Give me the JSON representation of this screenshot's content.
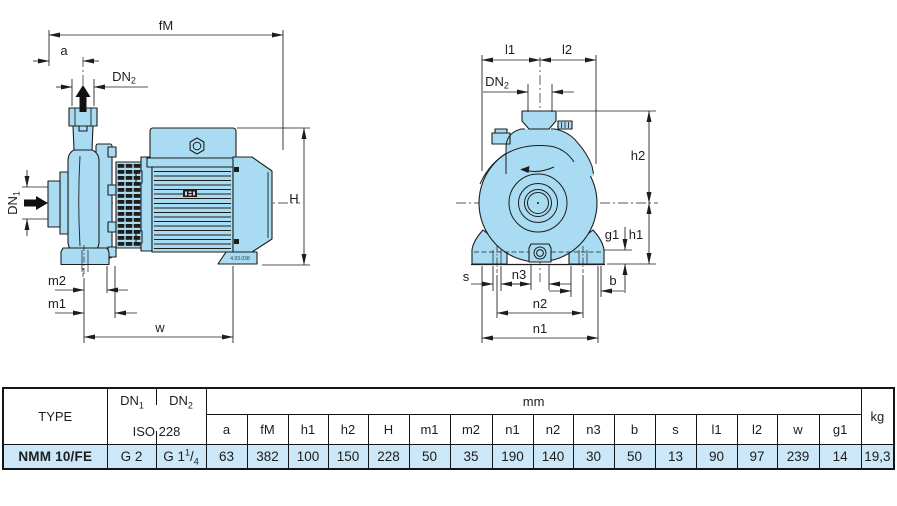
{
  "colors": {
    "pump_fill": "#a9dcf3",
    "line": "#1d1d1b",
    "highlight_row": "#cbe7f8"
  },
  "side_view": {
    "dim_fm": "fM",
    "dim_a": "a",
    "dn2": {
      "base": "DN",
      "sub": "2"
    },
    "dn1": {
      "base": "DN",
      "sub": "1"
    },
    "dim_h": "H",
    "dim_m2": "m2",
    "dim_m1": "m1",
    "dim_w": "w",
    "drawing_no": "4.93.038"
  },
  "front_view": {
    "dim_l1": "l1",
    "dim_l2": "l2",
    "dn2": {
      "base": "DN",
      "sub": "2"
    },
    "dim_h2": "h2",
    "dim_h1": "h1",
    "dim_g1": "g1",
    "dim_s": "s",
    "dim_n3": "n3",
    "dim_b": "b",
    "dim_n2": "n2",
    "dim_n1": "n1"
  },
  "table": {
    "type_header": "TYPE",
    "dn1": {
      "base": "DN",
      "sub": "1"
    },
    "dn2": {
      "base": "DN",
      "sub": "2"
    },
    "iso": "ISO 228",
    "mm": "mm",
    "kg": "kg",
    "dims": [
      "a",
      "fM",
      "h1",
      "h2",
      "H",
      "m1",
      "m2",
      "n1",
      "n2",
      "n3",
      "b",
      "s",
      "l1",
      "l2",
      "w",
      "g1"
    ],
    "row": {
      "type": "NMM 10/FE",
      "dn1_value": "G 2",
      "dn2_value": {
        "prefix": "G 1",
        "sup": "1",
        "sep": "/",
        "sub": "4"
      },
      "values": [
        "63",
        "382",
        "100",
        "150",
        "228",
        "50",
        "35",
        "190",
        "140",
        "30",
        "50",
        "13",
        "90",
        "97",
        "239",
        "14"
      ],
      "kg": "19,3"
    }
  }
}
